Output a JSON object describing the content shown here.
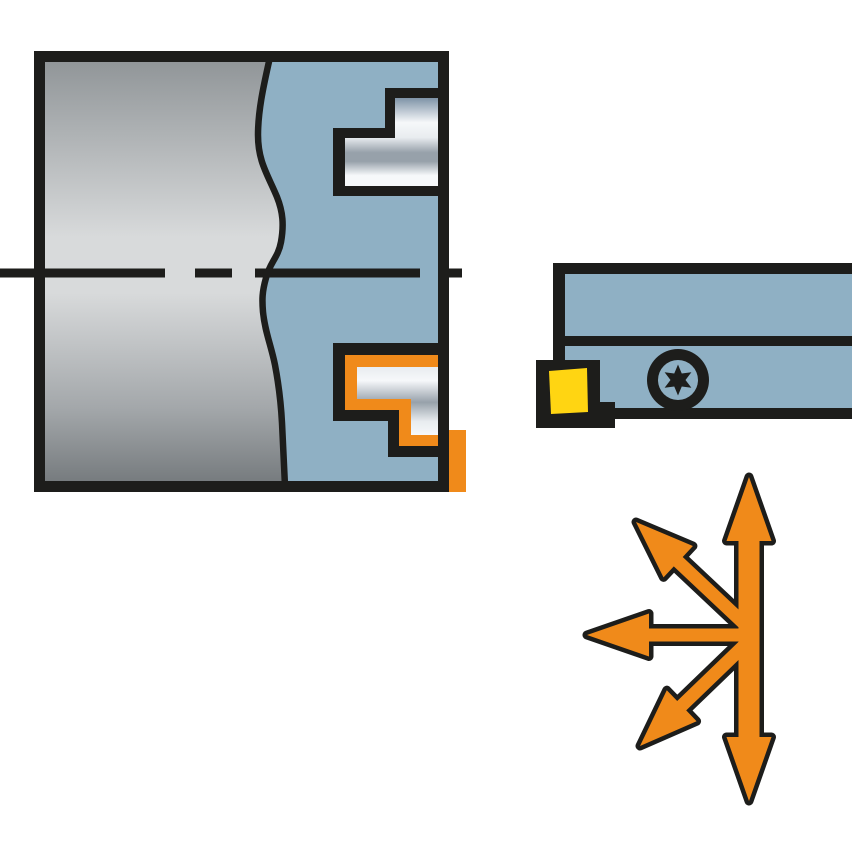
{
  "page": {
    "description": "Technical catalog illustration of a face-grooving turning tool: cross-section of the tool engaged in a workpiece, side view of the tool holder with indexable insert and Torx clamping screw, and a multi-directional arrow cluster showing possible feed directions."
  },
  "colors": {
    "background": "#ffffff",
    "outline": "#1d1d1b",
    "tool_blue": "#8fb0c4",
    "highlight_orange": "#f08a1a",
    "insert_yellow": "#ffd512",
    "workpiece_gray_dark": "#8f9497",
    "workpiece_gray_light": "#d8dadb",
    "workpiece_gray_mid": "#a3a7aa",
    "workpiece_gray_deep": "#74797c",
    "metal_dark": "#7e93a7",
    "metal_mid": "#97a1aa",
    "metal_light": "#f6f8fa",
    "metal_sheen": "#e8ecef"
  },
  "figures": {
    "cross_section": {
      "label": "tool-in-workpiece-cross-section",
      "parts": {
        "workpiece": "workpiece (gray, shown with break line)",
        "tool_body": "tool body cross-section (blue)",
        "upper_step": "machined step, upper half",
        "lower_step": "machined step, lower half (highlighted orange)",
        "insert_tip": "insert tip highlight outside frame",
        "centerline": "rotation axis centerline (dashed)"
      }
    },
    "tool_holder": {
      "label": "tool-holder-side-view",
      "parts": {
        "shank_upper": "holder shank upper bar",
        "shank_lower": "holder head lower bar",
        "insert_pocket": "insert pocket / cartridge (black)",
        "insert": "indexable cutting insert (yellow)",
        "screw": "torx-screw"
      }
    },
    "direction_arrows": {
      "label": "feed-direction-arrows",
      "directions": [
        "up",
        "down",
        "left",
        "up-left",
        "down-left"
      ]
    }
  }
}
